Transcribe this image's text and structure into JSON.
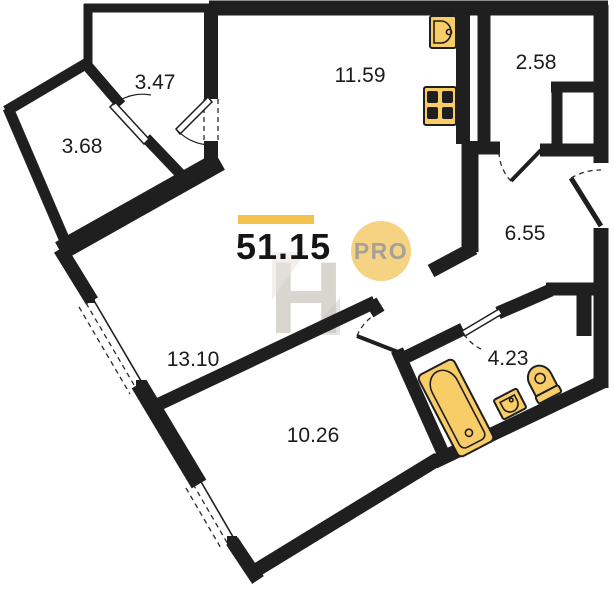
{
  "plan": {
    "total": {
      "area": "51.15"
    },
    "badge": {
      "label": "PRO"
    },
    "watermark": {
      "letter": "H"
    },
    "rooms": [
      {
        "id": "balcony-top",
        "area": "3.47"
      },
      {
        "id": "balcony-left",
        "area": "3.68"
      },
      {
        "id": "kitchen",
        "area": "11.59"
      },
      {
        "id": "hallway",
        "area": "2.58"
      },
      {
        "id": "corridor",
        "area": "6.55"
      },
      {
        "id": "living-room",
        "area": "13.10"
      },
      {
        "id": "bedroom",
        "area": "10.26"
      },
      {
        "id": "bathroom",
        "area": "4.23"
      }
    ],
    "fixtures": [
      "kitchen-sink",
      "stove",
      "bathtub",
      "washbasin",
      "toilet"
    ],
    "colors": {
      "wall": "#1f1f1f",
      "fixture": "#F8CC66",
      "accent_bar": "#F2C24D",
      "badge_bg": "#F6D283",
      "badge_text": "#A5A198",
      "watermark": "#D8D4CE",
      "label": "#1B1B1B"
    }
  }
}
